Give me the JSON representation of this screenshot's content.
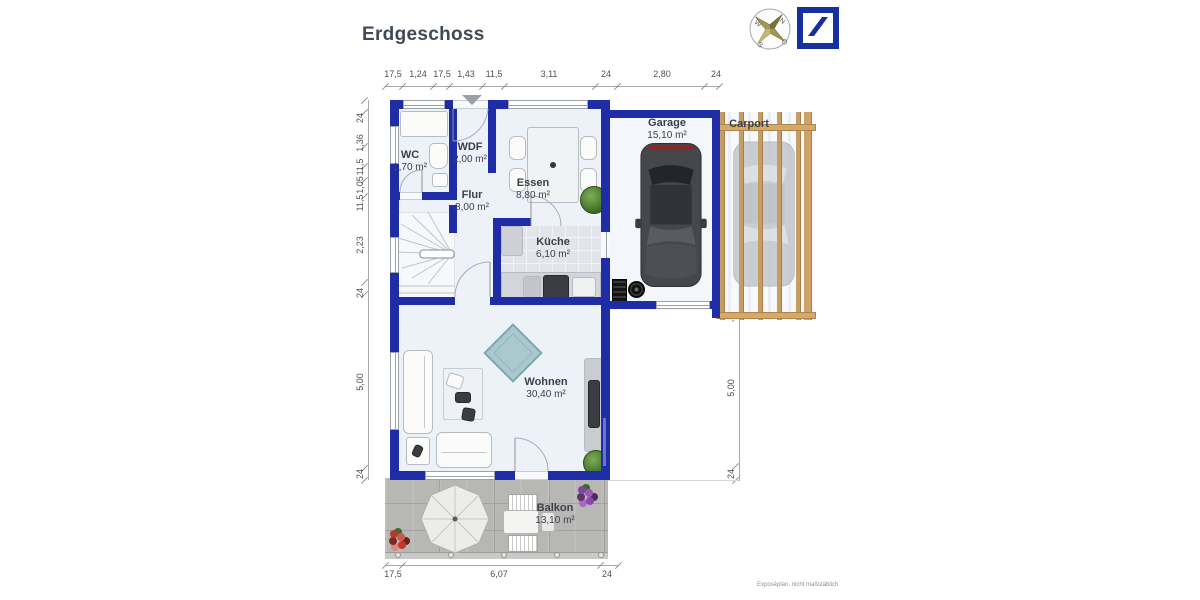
{
  "title": "Erdgeschoss",
  "compass": {
    "n": "N",
    "o": "O",
    "s": "S",
    "w": "W"
  },
  "dims": {
    "top": [
      "17,5",
      "1,24",
      "17,5",
      "1,43",
      "11,5",
      "3,11",
      "24",
      "2,80",
      "24"
    ],
    "left": [
      "24",
      "1,36",
      "11,5",
      "1,05",
      "11,5",
      "2,23",
      "24",
      "5,00",
      "24"
    ],
    "right": [
      "5,00",
      "24"
    ],
    "bottom": [
      "17,5",
      "6,07",
      "24"
    ]
  },
  "rooms": {
    "wc": {
      "name": "WC",
      "area": "1,70 m²"
    },
    "wdf": {
      "name": "WDF",
      "area": "2,00 m²"
    },
    "flur": {
      "name": "Flur",
      "area": "8,00 m²"
    },
    "essen": {
      "name": "Essen",
      "area": "8,80 m²"
    },
    "kueche": {
      "name": "Küche",
      "area": "6,10 m²"
    },
    "garage": {
      "name": "Garage",
      "area": "15,10 m²"
    },
    "carport": {
      "name": "Carport"
    },
    "wohnen": {
      "name": "Wohnen",
      "area": "30,40 m²"
    },
    "balkon": {
      "name": "Balkon",
      "area": "13,10 m²"
    }
  },
  "footnote": "Exposéplan, nicht maßstäblich",
  "colors": {
    "wall_blue": "#1e2da6",
    "logo_blue": "#16319e",
    "floor": "#edf1f8",
    "wood": "#c79e62",
    "terrace_gray": "#b7b7b5",
    "ottoman_teal": "#a9c9cf"
  }
}
